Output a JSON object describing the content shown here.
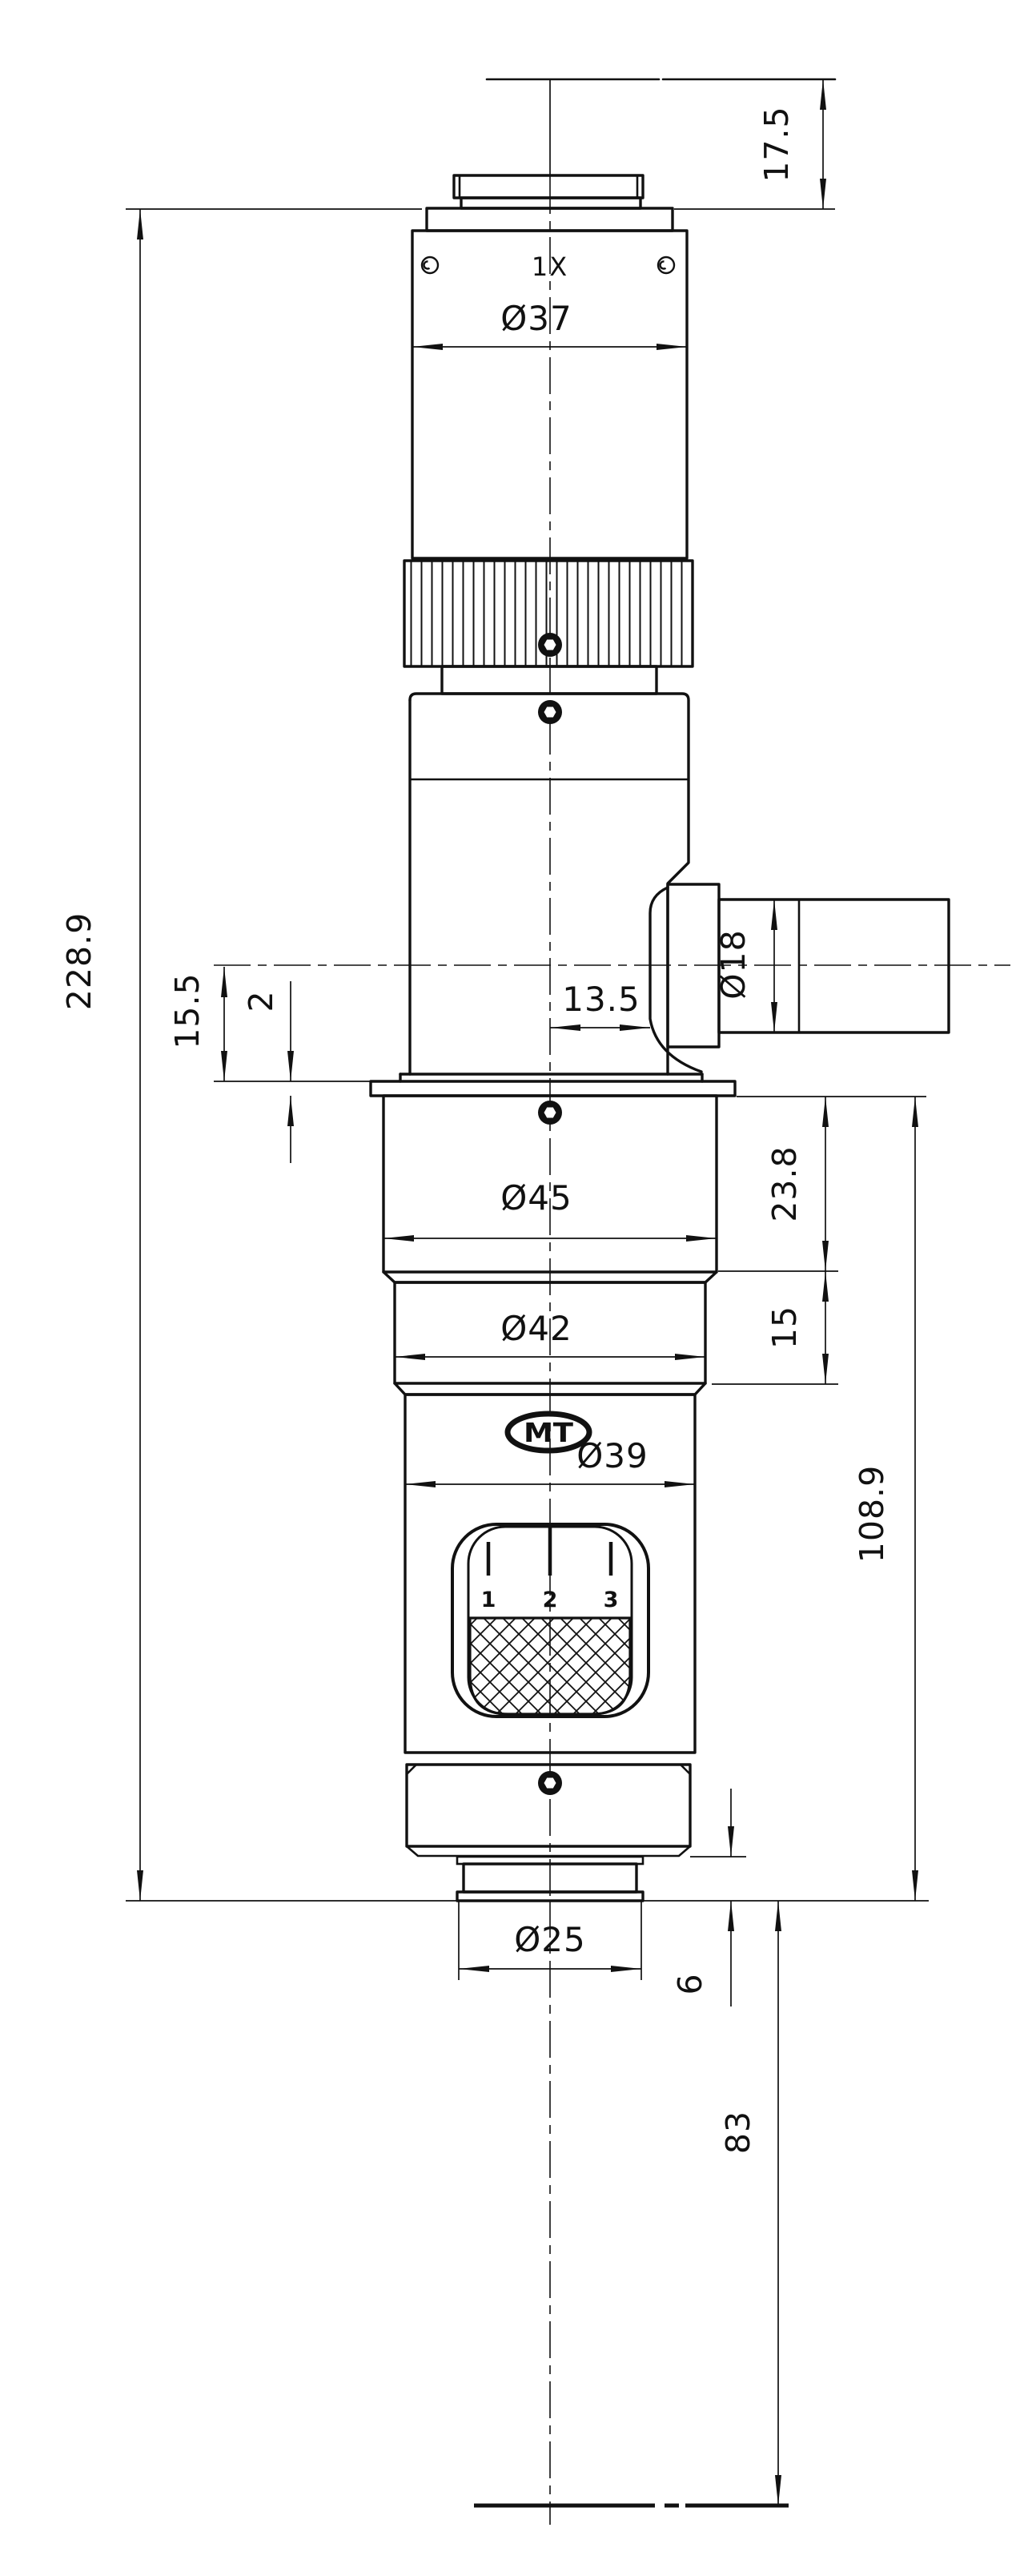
{
  "drawing": {
    "magnification_label": "1X",
    "logo": "MT",
    "zoom_scale_marks": [
      "1",
      "2",
      "3"
    ],
    "dimensions": {
      "top_adapter_height": "17.5",
      "overall_height": "228.9",
      "port_axis_to_flange": "15.5",
      "flange_thickness": "2",
      "center_to_port_face": "13.5",
      "port_diameter": "Ø18",
      "body_diameter": "Ø37",
      "upper_barrel_diameter": "Ø45",
      "mid_barrel_diameter": "Ø42",
      "zoom_body_diameter": "Ø39",
      "tip_diameter": "Ø25",
      "upper_barrel_height": "23.8",
      "mid_barrel_height": "15",
      "flange_to_tip_height": "108.9",
      "tip_step_height": "6",
      "working_distance": "83"
    },
    "line_color": "#111111",
    "background_color": "#ffffff"
  }
}
